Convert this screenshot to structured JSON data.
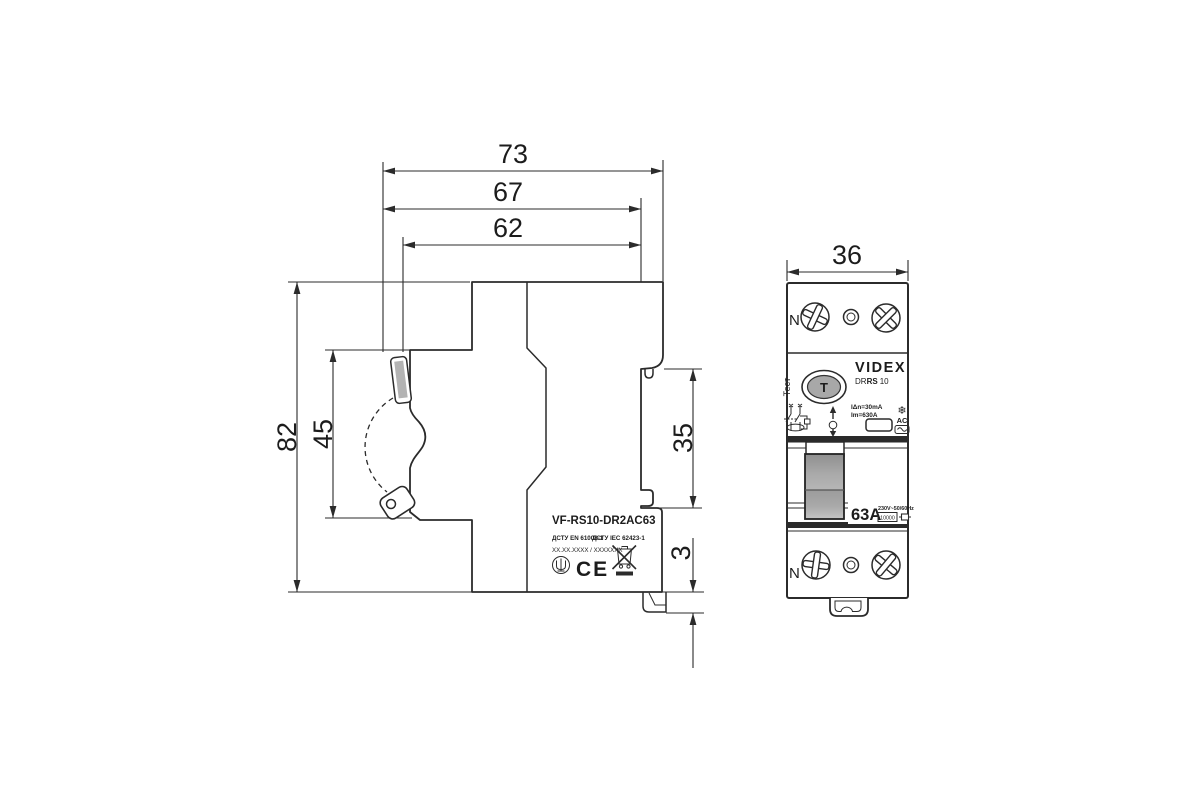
{
  "side_view": {
    "dims": {
      "overall_depth": "73",
      "depth_to_rail": "67",
      "body_depth": "62",
      "overall_height": "82",
      "front_height": "45",
      "rail_recess_height": "35",
      "clip_travel": "3"
    },
    "label": {
      "model": "VF-RS10-DR2AC63",
      "standard1": "ДСТУ EN 61008-1",
      "standard2": "ДСТУ IEC 62423-1",
      "serial": "XX.XX.XXXX / XXXXXXX",
      "ce_mark": "CE"
    }
  },
  "front_view": {
    "dims": {
      "width": "36"
    },
    "terminal_top_label": "N",
    "terminal_bottom_label": "N",
    "brand": "VIDEX",
    "model_dr": "DR",
    "model_rs": "RS",
    "model_num": "10",
    "test_label": "Тест",
    "test_button": "T",
    "rating_idn": "IΔn=30mA",
    "rating_im": "Im=630A",
    "type_ac": "AC",
    "current": "63A",
    "voltage": "230V~50/60Hz",
    "breaking_capacity": "10000"
  },
  "colors": {
    "line": "#2b2b2b",
    "handle_gray": "#a8a8a8",
    "band_dark": "#2a2a2a"
  }
}
